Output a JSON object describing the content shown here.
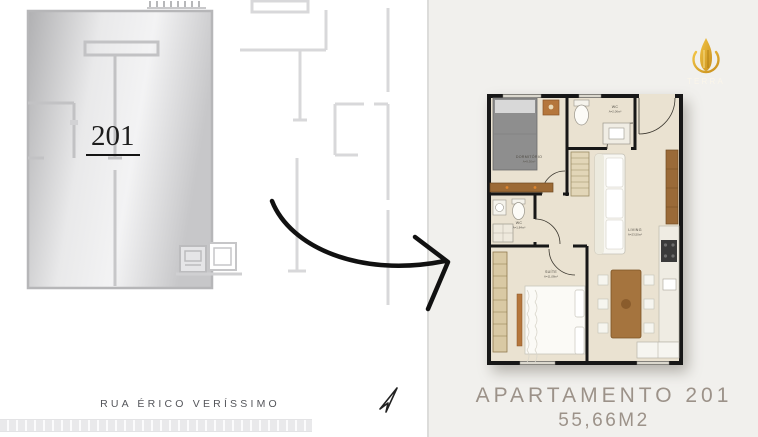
{
  "left_panel": {
    "unit_label": "201",
    "street_label": "RUA ÉRICO VERÍSSIMO"
  },
  "right_panel": {
    "caption_line1": "APARTAMENTO 201",
    "caption_line2": "55,66M2",
    "logo_text": "TERRA",
    "rooms": {
      "dormitorio": {
        "name": "DORMITÓRIO",
        "area": "A=9,30m²"
      },
      "wc_top": {
        "name": "WC",
        "area": "A=2,06m²"
      },
      "wc_suite": {
        "name": "WC",
        "area": "A=1,84m²"
      },
      "suite": {
        "name": "SUÍTE",
        "area": "A=11,08m²"
      },
      "living": {
        "name": "LIVING",
        "area": "A=23,50m²"
      }
    }
  },
  "icons": {
    "transition_arrow": "hand-drawn-arrow-right",
    "cursor": "cursor-pointer",
    "logo_flame": "gold-flame-building"
  },
  "colors": {
    "right_panel_bg": "#f1f0ed",
    "caption_text": "#9c9289",
    "plan_wall": "#171717",
    "plan_floor": "#eae2d1",
    "site_wall_light": "#d8d8da",
    "unit_fill_dark": "#b3b3b5",
    "logo_gold": "#d9a523",
    "arrow_black": "#111111"
  }
}
